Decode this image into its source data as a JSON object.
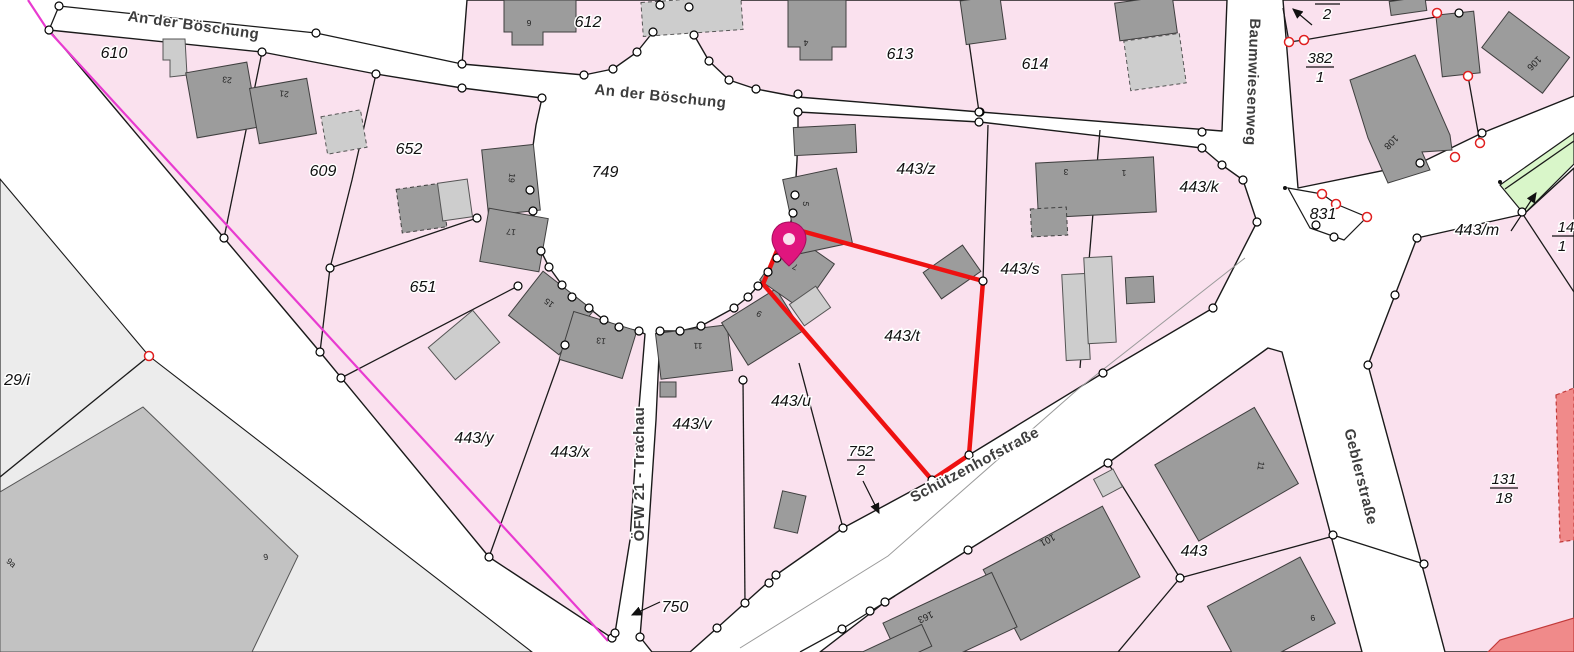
{
  "app": {
    "type": "cadastral-map-viewer"
  },
  "streets": {
    "an_der_boeschung": "An der Böschung",
    "schuetzenhofstrasse": "Schützenhofstraße",
    "baumwiesenweg": "Baumwiesenweg",
    "geblerstrasse": "Geblerstraße",
    "oefw_trachau": "ÖFW 21 - Trachau"
  },
  "parcels": {
    "p610": "610",
    "p612": "612",
    "p613": "613",
    "p614": "614",
    "p609": "609",
    "p652": "652",
    "p651": "651",
    "p749": "749",
    "p750": "750",
    "p831": "831",
    "p443": "443",
    "p443z": "443/z",
    "p443k": "443/k",
    "p443s": "443/s",
    "p443t": "443/t",
    "p443u": "443/u",
    "p443v": "443/v",
    "p443x": "443/x",
    "p443y": "443/y",
    "p443m": "443/m",
    "p29i": "29/i"
  },
  "fractions": {
    "f752": {
      "num": "752",
      "den": "2"
    },
    "f382": {
      "num": "382",
      "den": "1"
    },
    "f131": {
      "num": "131",
      "den": "18"
    },
    "f14": {
      "num": "14",
      "den": "1"
    },
    "f2": {
      "den": "2"
    }
  },
  "house_numbers": {
    "h23": "23",
    "h21": "21",
    "h19": "19",
    "h17": "17",
    "h15": "15",
    "h13": "13",
    "h11": "11",
    "h9": "9",
    "h7": "7",
    "h5": "5",
    "h6": "6",
    "h4": "4",
    "h3": "3",
    "h1": "1",
    "h106": "106",
    "h108": "108",
    "h101": "101",
    "h163": "163",
    "h9a": "9a"
  },
  "marker": {
    "name": "location-pin",
    "color": "#e0157e"
  },
  "highlight": {
    "parcel": "443/t",
    "color": "#ee1111"
  },
  "colors": {
    "parcel_pink": "#fae1ee",
    "street_white": "#ffffff",
    "building_dark": "#9c9c9c",
    "building_light": "#cdcdcd",
    "area_gray": "#ececec",
    "green_parcel": "#d9f6c9",
    "salmon_building": "#f08a8a",
    "boundary_magenta": "#e83bd0"
  }
}
